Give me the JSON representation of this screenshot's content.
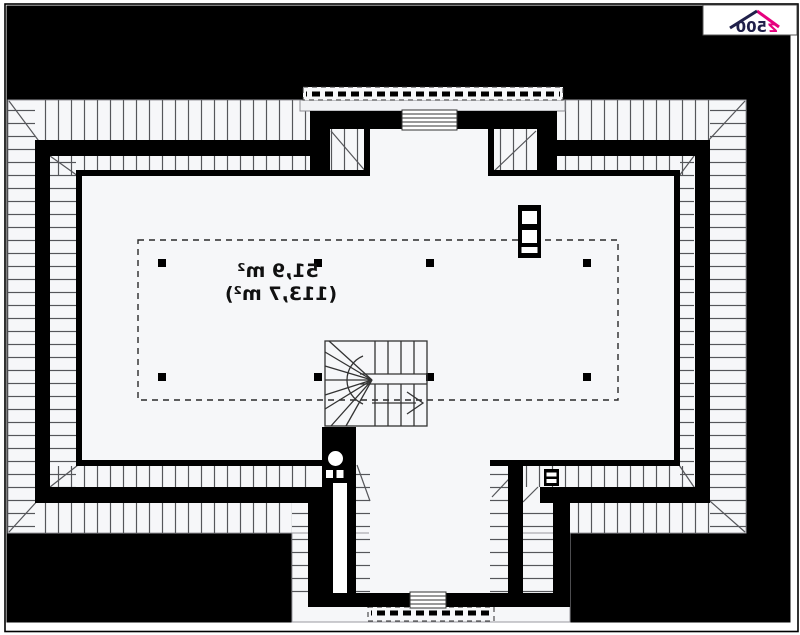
{
  "logo": {
    "brand_z": "z",
    "brand_num": "500",
    "brand_pink": "#e6007e",
    "brand_dark": "#20204a"
  },
  "floor_plan": {
    "area_label_primary": "51,9 m²",
    "area_label_secondary": "(113,7 m²)",
    "text_mirrored": true,
    "colors": {
      "sheet_background": "#000000",
      "plan_fill": "#f6f7f9",
      "wall": "#000000",
      "hatch_line": "#55565a",
      "dashed_line": "#2a2a2a"
    }
  }
}
